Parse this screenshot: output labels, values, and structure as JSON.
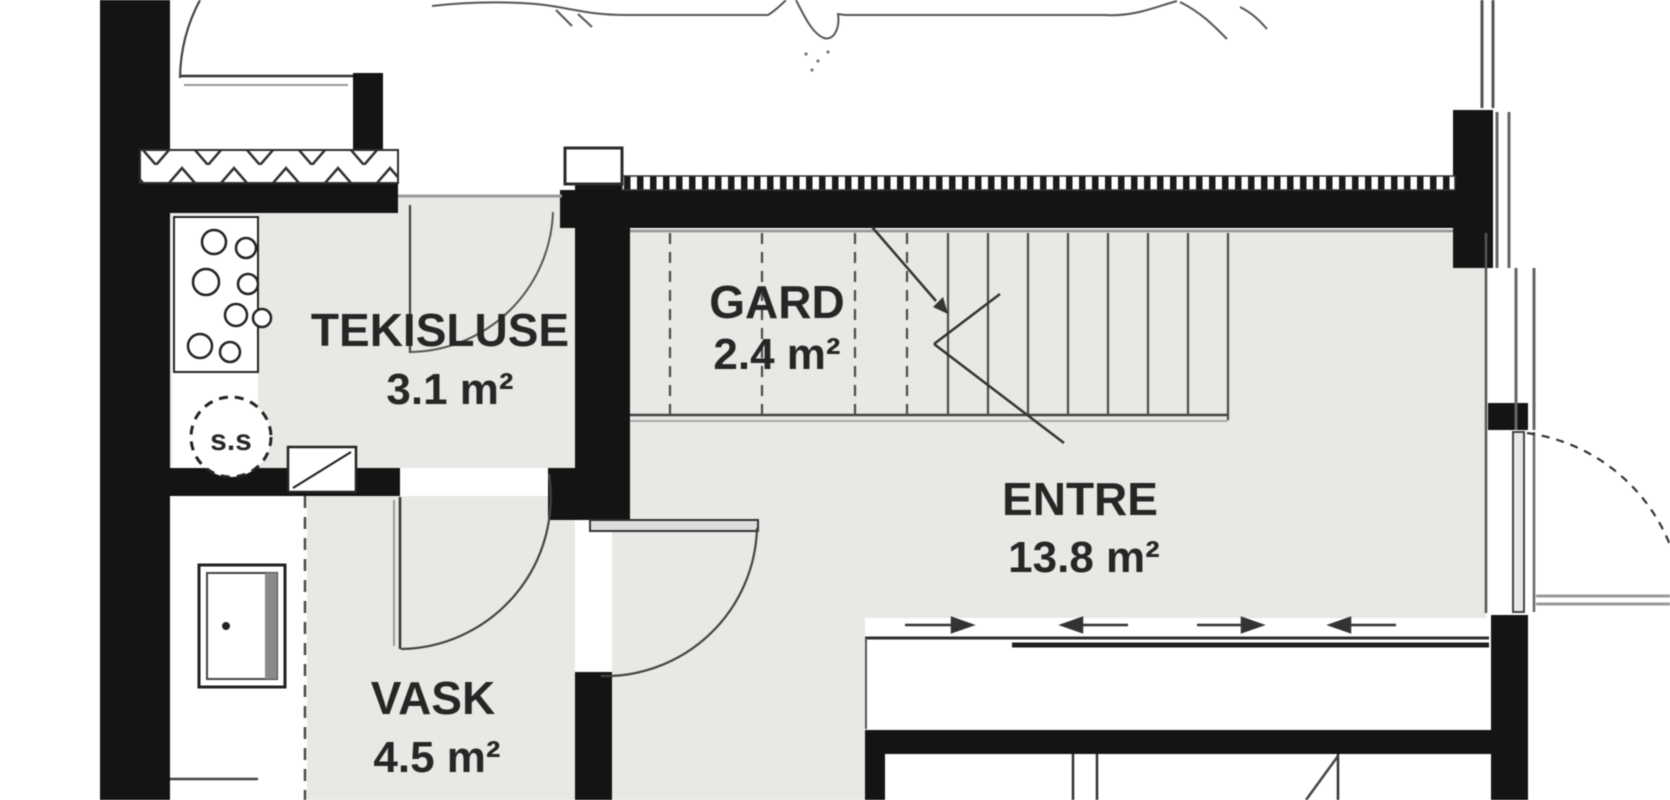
{
  "plan": {
    "type": "architectural-floor-plan",
    "rooms": [
      {
        "name": "TEKISLUSE",
        "area": "3.1 m²"
      },
      {
        "name": "GARD",
        "area": "2.4 m²"
      },
      {
        "name": "ENTRE",
        "area": "13.8 m²"
      },
      {
        "name": "VASK",
        "area": "4.5 m²"
      }
    ],
    "symbols": {
      "circle_label": "s.s"
    },
    "colors": {
      "background": "#ffffff",
      "wall": "#141414",
      "floor": "#e9e8e4",
      "line": "#3f3f3f",
      "shadow_line": "#999999"
    }
  }
}
